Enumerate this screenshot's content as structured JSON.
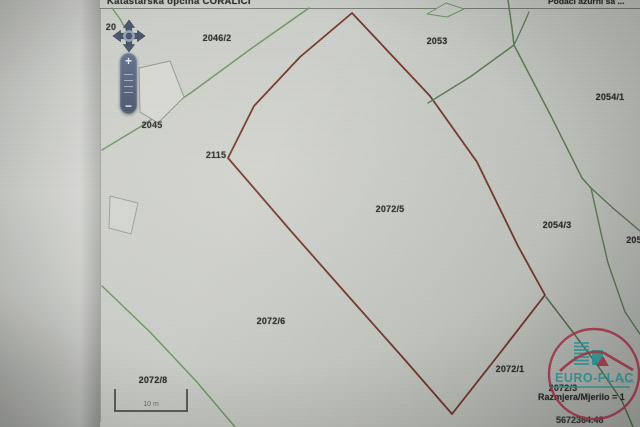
{
  "header": {
    "left_title": "Katastarska općina CORALICI",
    "right_info": "Podaci ažurni sa ..."
  },
  "controls": {
    "zoom_in_label": "+",
    "zoom_out_label": "−"
  },
  "scalebar": {
    "label": "10 m"
  },
  "logo": {
    "text": "EURO-PLAC",
    "suffix": "d.o.o."
  },
  "footer": {
    "scale_label": "Razmjera/Mjerilo = 1",
    "coordinate": "5672364.48"
  },
  "colors": {
    "boundary_red": "#7e3629",
    "path_green": "#6d9a60",
    "logo_teal": "#1db5b5",
    "logo_red": "#cf3650"
  },
  "map": {
    "parcel_labels": [
      {
        "text": "20",
        "x": 111,
        "y": 27
      },
      {
        "text": "2046/2",
        "x": 217,
        "y": 38
      },
      {
        "text": "2053",
        "x": 437,
        "y": 41
      },
      {
        "text": "2054/1",
        "x": 610,
        "y": 97
      },
      {
        "text": "2045",
        "x": 152,
        "y": 125
      },
      {
        "text": "2115",
        "x": 216,
        "y": 155
      },
      {
        "text": "2072/5",
        "x": 390,
        "y": 209
      },
      {
        "text": "2054/3",
        "x": 557,
        "y": 225
      },
      {
        "text": "205",
        "x": 634,
        "y": 240
      },
      {
        "text": "2072/6",
        "x": 271,
        "y": 321
      },
      {
        "text": "2072/1",
        "x": 510,
        "y": 369
      },
      {
        "text": "2072/3",
        "x": 563,
        "y": 388
      },
      {
        "text": "2072/8",
        "x": 153,
        "y": 380
      }
    ],
    "paths": [
      {
        "name": "red-parcel-boundary",
        "points": [
          [
            352,
            13
          ],
          [
            300,
            57
          ],
          [
            254,
            106
          ],
          [
            228,
            158
          ],
          [
            290,
            230
          ],
          [
            350,
            298
          ],
          [
            405,
            360
          ],
          [
            452,
            414
          ],
          [
            500,
            353
          ],
          [
            545,
            295
          ],
          [
            518,
            246
          ],
          [
            477,
            162
          ],
          [
            430,
            96
          ]
        ],
        "stroke": "#7e3629",
        "width": 1.8,
        "closed": true
      },
      {
        "name": "green-path-northwest",
        "points": [
          [
            309,
            8
          ],
          [
            252,
            48
          ],
          [
            192,
            92
          ],
          [
            140,
            127
          ],
          [
            102,
            150
          ]
        ],
        "stroke": "#6d9a60",
        "width": 1.5
      },
      {
        "name": "green-path-southwest",
        "points": [
          [
            102,
            286
          ],
          [
            150,
            332
          ],
          [
            196,
            381
          ],
          [
            235,
            427
          ]
        ],
        "stroke": "#6d9a60",
        "width": 1.5
      },
      {
        "name": "green-path-north",
        "points": [
          [
            508,
            0
          ],
          [
            512,
            28
          ],
          [
            514,
            45
          ]
        ],
        "stroke": "#5d8353",
        "width": 1.5
      },
      {
        "name": "green-branch-north",
        "points": [
          [
            514,
            45
          ],
          [
            522,
            28
          ],
          [
            529,
            12
          ]
        ],
        "stroke": "#5d8353",
        "width": 1.3
      },
      {
        "name": "green-path-2053-boundary",
        "points": [
          [
            428,
            103
          ],
          [
            470,
            77
          ],
          [
            514,
            45
          ]
        ],
        "stroke": "#5d8353",
        "width": 1.5
      },
      {
        "name": "green-path-east",
        "points": [
          [
            514,
            45
          ],
          [
            552,
            118
          ],
          [
            582,
            178
          ],
          [
            591,
            188
          ]
        ],
        "stroke": "#5d8353",
        "width": 1.5
      },
      {
        "name": "green-fork-northeast",
        "points": [
          [
            591,
            188
          ],
          [
            614,
            209
          ],
          [
            640,
            231
          ]
        ],
        "stroke": "#5d8353",
        "width": 1.4
      },
      {
        "name": "green-fork-southeast",
        "points": [
          [
            591,
            188
          ],
          [
            601,
            233
          ],
          [
            608,
            263
          ],
          [
            625,
            312
          ],
          [
            640,
            334
          ]
        ],
        "stroke": "#5d8353",
        "width": 1.4
      },
      {
        "name": "green-path-south-southeast",
        "points": [
          [
            546,
            297
          ],
          [
            572,
            331
          ],
          [
            598,
            366
          ],
          [
            622,
            401
          ],
          [
            633,
            427
          ]
        ],
        "stroke": "#54754c",
        "width": 1.5
      },
      {
        "name": "green-path-top-left-corner",
        "points": [
          [
            112,
            8
          ],
          [
            120,
            19
          ],
          [
            127,
            31
          ]
        ],
        "stroke": "#6d9a60",
        "width": 1.4
      },
      {
        "name": "building-2045",
        "points": [
          [
            139,
            68
          ],
          [
            170,
            61
          ],
          [
            184,
            97
          ],
          [
            158,
            123
          ],
          [
            140,
            112
          ]
        ],
        "stroke": "#8f998d",
        "width": 1,
        "closed": true,
        "fill": "#d9dbd4"
      },
      {
        "name": "building-west",
        "points": [
          [
            110,
            196
          ],
          [
            138,
            203
          ],
          [
            131,
            234
          ],
          [
            109,
            228
          ]
        ],
        "stroke": "#9aa598",
        "width": 1,
        "closed": true,
        "fill": "#d6d8d2"
      },
      {
        "name": "building-north",
        "points": [
          [
            427,
            14
          ],
          [
            446,
            3
          ],
          [
            464,
            9
          ],
          [
            447,
            17
          ]
        ],
        "stroke": "#6d9a60",
        "width": 1,
        "closed": true,
        "fill": "#ccd0c8"
      }
    ]
  }
}
